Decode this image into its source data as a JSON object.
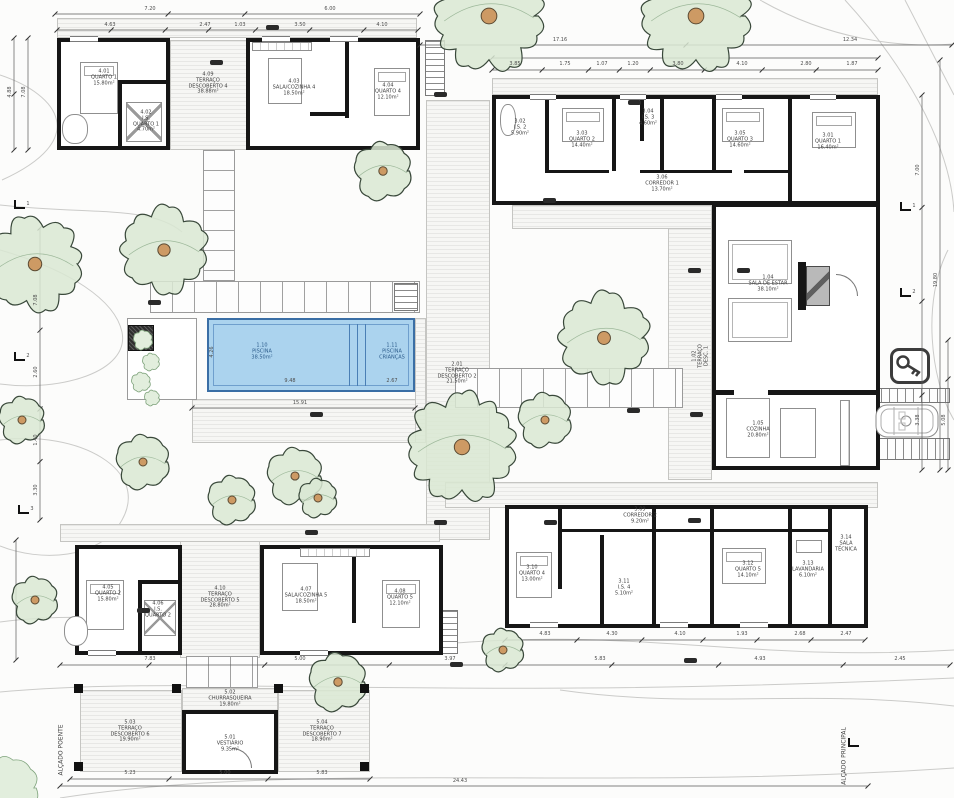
{
  "plan": {
    "pool_fill": "#abd3ee",
    "pool_border": "#3a6ea5",
    "tree_fill": "#d9e8d2",
    "tree_trunk": "#cd9a64",
    "wall_color": "#161616"
  },
  "labels": [
    {
      "n": "suiteA-quarto",
      "x": 104,
      "y": 78,
      "t": "4.01\nQUARTO 1\n15.80m²"
    },
    {
      "n": "suiteA-is",
      "x": 146,
      "y": 122,
      "t": "4.02\nI.S.\nQUARTO 1\n4.70m²"
    },
    {
      "n": "deck-top",
      "x": 208,
      "y": 84,
      "t": "4.09\nTERRAÇO\nDESCOBERTO 4\n38.88m²"
    },
    {
      "n": "suiteB-sala",
      "x": 294,
      "y": 88,
      "t": "4.03\nSALA/COZINHA 4\n18.50m²"
    },
    {
      "n": "suiteB-quarto",
      "x": 388,
      "y": 92,
      "t": "4.04\nQUARTO 4\n12.10m²"
    },
    {
      "n": "wing-is2",
      "x": 520,
      "y": 128,
      "t": "3.02\nI.S. 2\n5.90m²"
    },
    {
      "n": "wing-q2",
      "x": 582,
      "y": 140,
      "t": "3.03\nQUARTO 2\n14.40m²"
    },
    {
      "n": "wing-is3",
      "x": 648,
      "y": 118,
      "t": "3.04\nI.S. 3\n4.60m²"
    },
    {
      "n": "wing-q3",
      "x": 740,
      "y": 140,
      "t": "3.05\nQUARTO 3\n14.60m²"
    },
    {
      "n": "wing-q1",
      "x": 828,
      "y": 142,
      "t": "3.01\nQUARTO 1\n16.40m²"
    },
    {
      "n": "corredor-1",
      "x": 662,
      "y": 184,
      "t": "3.06\nCORREDOR 1\n13.70m²"
    },
    {
      "n": "sala-estar",
      "x": 768,
      "y": 284,
      "t": "1.04\nSALA DE ESTAR\n38.10m²"
    },
    {
      "n": "cozinha",
      "x": 758,
      "y": 430,
      "t": "1.05\nCOZINHA\n20.80m²"
    },
    {
      "n": "deck-court",
      "x": 701,
      "y": 356,
      "t": "1.02\nTERRAÇO\nDESC. 1",
      "rot": -90
    },
    {
      "n": "deck-left",
      "x": 457,
      "y": 374,
      "t": "2.01\nTERRAÇO\nDESCOBERTO 2\n21.50m²"
    },
    {
      "n": "piscina",
      "x": 262,
      "y": 352,
      "t": "1.10\nPISCINA\n38.50m²",
      "c": "#2a5a8a"
    },
    {
      "n": "piscina-criancas",
      "x": 392,
      "y": 352,
      "t": "1.11\nPISCINA\nCRIANÇAS",
      "c": "#2a5a8a"
    },
    {
      "n": "bw-q4",
      "x": 532,
      "y": 574,
      "t": "3.10\nQUARTO 4\n13.00m²"
    },
    {
      "n": "bw-is4",
      "x": 624,
      "y": 588,
      "t": "3.11\nI.S. 4\n5.10m²"
    },
    {
      "n": "corredor-2",
      "x": 640,
      "y": 516,
      "t": "3.09\nCORREDOR 2\n9.20m²"
    },
    {
      "n": "bw-q5",
      "x": 748,
      "y": 570,
      "t": "3.12\nQUARTO 5\n14.10m²"
    },
    {
      "n": "bw-lav",
      "x": 808,
      "y": 570,
      "t": "3.13\nLAVANDARIA\n6.10m²"
    },
    {
      "n": "bw-tec",
      "x": 846,
      "y": 544,
      "t": "3.14\nSALA\nTÉCNICA"
    },
    {
      "n": "suiteC-quarto",
      "x": 108,
      "y": 594,
      "t": "4.05\nQUARTO 2\n15.80m²"
    },
    {
      "n": "suiteC-is",
      "x": 158,
      "y": 610,
      "t": "4.06\nI.S.\nQUARTO 2"
    },
    {
      "n": "deck-bottom",
      "x": 220,
      "y": 598,
      "t": "4.10\nTERRAÇO\nDESCOBERTO 5\n28.80m²"
    },
    {
      "n": "suiteD-sala",
      "x": 306,
      "y": 596,
      "t": "4.07\nSALA/COZINHA 5\n18.50m²"
    },
    {
      "n": "suiteD-quarto",
      "x": 400,
      "y": 598,
      "t": "4.08\nQUARTO 5\n12.10m²"
    },
    {
      "n": "churrasqueira",
      "x": 230,
      "y": 699,
      "t": "5.02\nCHURRASQUEIRA\n19.80m²"
    },
    {
      "n": "vestiario",
      "x": 230,
      "y": 744,
      "t": "5.01\nVESTIÁRIO\n9.35m²"
    },
    {
      "n": "deck-ent-left",
      "x": 130,
      "y": 732,
      "t": "5.03\nTERRAÇO\nDESCOBERTO 6\n19.90m²"
    },
    {
      "n": "deck-ent-right",
      "x": 322,
      "y": 732,
      "t": "5.04\nTERRAÇO\nDESCOBERTO 7\n18.90m²"
    },
    {
      "n": "alcado-principal",
      "x": 845,
      "y": 756,
      "t": "ALÇADO PRINCIPAL",
      "rot": -90,
      "s": 6
    },
    {
      "n": "alcado-poente",
      "x": 62,
      "y": 750,
      "t": "ALÇADO POENTE",
      "rot": -90,
      "s": 6
    }
  ],
  "dimensions": [
    {
      "x": 150,
      "y": 9,
      "t": "7.20"
    },
    {
      "x": 330,
      "y": 9,
      "t": "6.00"
    },
    {
      "x": 560,
      "y": 40,
      "t": "17.16"
    },
    {
      "x": 850,
      "y": 40,
      "t": "12.34"
    },
    {
      "x": 110,
      "y": 25,
      "t": "4.63"
    },
    {
      "x": 205,
      "y": 25,
      "t": "2.47"
    },
    {
      "x": 240,
      "y": 25,
      "t": "1.03"
    },
    {
      "x": 300,
      "y": 25,
      "t": "3.50"
    },
    {
      "x": 382,
      "y": 25,
      "t": "4.10"
    },
    {
      "x": 515,
      "y": 64,
      "t": "3.85"
    },
    {
      "x": 565,
      "y": 64,
      "t": "1.75"
    },
    {
      "x": 602,
      "y": 64,
      "t": "1.07"
    },
    {
      "x": 633,
      "y": 64,
      "t": "1.20"
    },
    {
      "x": 678,
      "y": 64,
      "t": "3.80"
    },
    {
      "x": 742,
      "y": 64,
      "t": "4.10"
    },
    {
      "x": 806,
      "y": 64,
      "t": "2.80"
    },
    {
      "x": 852,
      "y": 64,
      "t": "1.87"
    },
    {
      "x": 10,
      "y": 92,
      "t": "4.88",
      "rot": -90
    },
    {
      "x": 24,
      "y": 92,
      "t": "7.08",
      "rot": -90
    },
    {
      "x": 36,
      "y": 300,
      "t": "7.08",
      "rot": -90
    },
    {
      "x": 36,
      "y": 372,
      "t": "2.60",
      "rot": -90
    },
    {
      "x": 36,
      "y": 440,
      "t": "1.40",
      "rot": -90
    },
    {
      "x": 36,
      "y": 490,
      "t": "3.30",
      "rot": -90
    },
    {
      "x": 918,
      "y": 170,
      "t": "7.00",
      "rot": -90
    },
    {
      "x": 936,
      "y": 280,
      "t": "19.80",
      "rot": -90
    },
    {
      "x": 918,
      "y": 420,
      "t": "3.38",
      "rot": -90
    },
    {
      "x": 944,
      "y": 420,
      "t": "5.08",
      "rot": -90
    },
    {
      "x": 300,
      "y": 403,
      "t": "15.91"
    },
    {
      "x": 290,
      "y": 381,
      "t": "9.48"
    },
    {
      "x": 392,
      "y": 381,
      "t": "2.67"
    },
    {
      "x": 212,
      "y": 352,
      "t": "4.26",
      "rot": -90
    },
    {
      "x": 150,
      "y": 659,
      "t": "7.83"
    },
    {
      "x": 300,
      "y": 659,
      "t": "5.00"
    },
    {
      "x": 450,
      "y": 659,
      "t": "3.97"
    },
    {
      "x": 600,
      "y": 659,
      "t": "5.83"
    },
    {
      "x": 760,
      "y": 659,
      "t": "4.93"
    },
    {
      "x": 900,
      "y": 659,
      "t": "2.45"
    },
    {
      "x": 545,
      "y": 634,
      "t": "4.83"
    },
    {
      "x": 612,
      "y": 634,
      "t": "4.30"
    },
    {
      "x": 680,
      "y": 634,
      "t": "4.10"
    },
    {
      "x": 742,
      "y": 634,
      "t": "1.93"
    },
    {
      "x": 800,
      "y": 634,
      "t": "2.68"
    },
    {
      "x": 846,
      "y": 634,
      "t": "2.47"
    },
    {
      "x": 130,
      "y": 773,
      "t": "5.23"
    },
    {
      "x": 225,
      "y": 773,
      "t": "5.00"
    },
    {
      "x": 322,
      "y": 773,
      "t": "5.83"
    },
    {
      "x": 460,
      "y": 781,
      "t": "24.43"
    }
  ],
  "trees": [
    [
      489,
      16,
      56
    ],
    [
      696,
      16,
      56
    ],
    [
      35,
      264,
      48
    ],
    [
      164,
      250,
      44
    ],
    [
      383,
      171,
      30
    ],
    [
      604,
      338,
      46
    ],
    [
      462,
      447,
      55
    ],
    [
      545,
      420,
      28
    ],
    [
      22,
      420,
      24
    ],
    [
      143,
      462,
      28
    ],
    [
      232,
      500,
      25
    ],
    [
      295,
      476,
      29
    ],
    [
      318,
      498,
      20
    ],
    [
      35,
      600,
      24
    ],
    [
      503,
      650,
      22
    ],
    [
      338,
      682,
      30
    ]
  ],
  "shrubs": [
    [
      8,
      788,
      32
    ],
    [
      143,
      340,
      10
    ],
    [
      151,
      362,
      9
    ],
    [
      141,
      382,
      10
    ],
    [
      152,
      398,
      8
    ]
  ],
  "tags": [
    [
      266,
      25
    ],
    [
      210,
      60
    ],
    [
      434,
      92
    ],
    [
      543,
      198
    ],
    [
      628,
      100
    ],
    [
      688,
      268
    ],
    [
      737,
      268
    ],
    [
      627,
      408
    ],
    [
      690,
      412
    ],
    [
      544,
      520
    ],
    [
      688,
      518
    ],
    [
      434,
      520
    ],
    [
      137,
      608
    ],
    [
      305,
      530
    ],
    [
      450,
      662
    ],
    [
      684,
      658
    ],
    [
      148,
      300
    ],
    [
      310,
      412
    ]
  ],
  "posts": [
    [
      74,
      684
    ],
    [
      172,
      684
    ],
    [
      274,
      684
    ],
    [
      360,
      684
    ],
    [
      74,
      762
    ],
    [
      360,
      762
    ]
  ],
  "section_markers": [
    {
      "x": 14,
      "y": 200,
      "t": "1"
    },
    {
      "x": 14,
      "y": 352,
      "t": "2"
    },
    {
      "x": 18,
      "y": 505,
      "t": "3"
    },
    {
      "x": 900,
      "y": 202,
      "t": "1"
    },
    {
      "x": 900,
      "y": 288,
      "t": "2"
    },
    {
      "x": 848,
      "y": 738,
      "t": ""
    }
  ]
}
